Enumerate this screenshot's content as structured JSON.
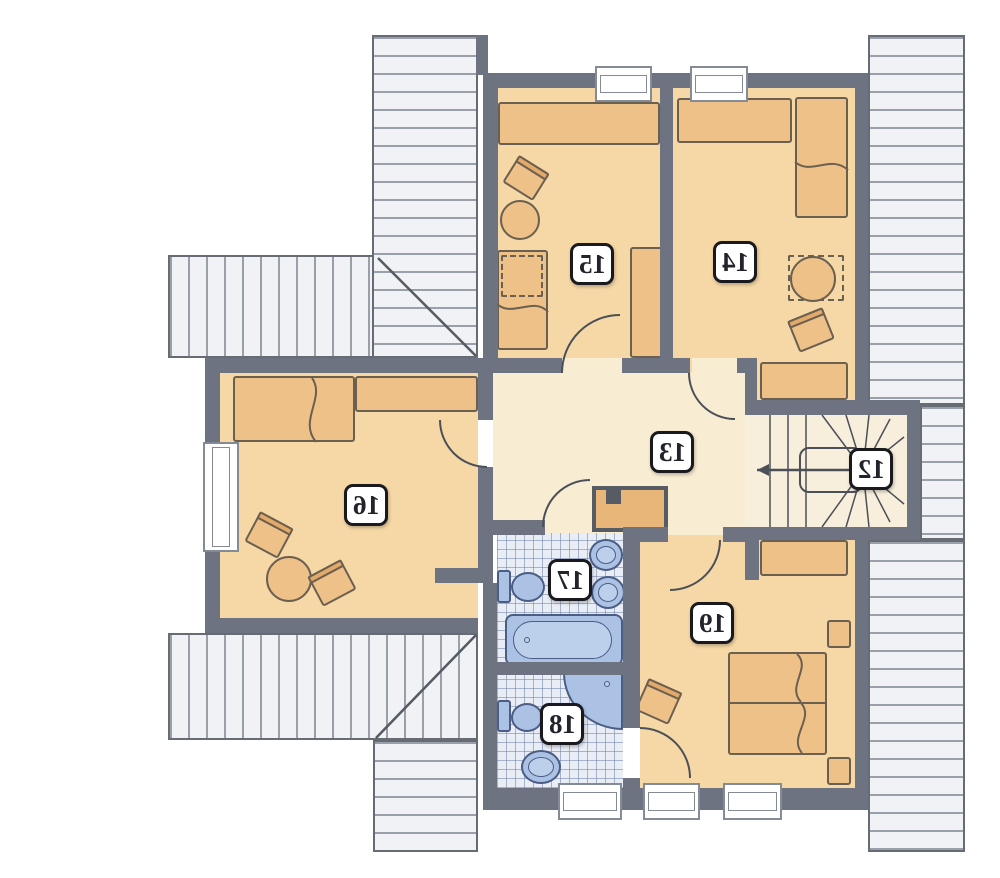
{
  "plan": {
    "type": "attic-floor-plan",
    "orientation": "mirrored",
    "room_count": 8
  },
  "rooms": [
    {
      "number": "12",
      "name": "staircase"
    },
    {
      "number": "13",
      "name": "hallway"
    },
    {
      "number": "14",
      "name": "bedroom"
    },
    {
      "number": "15",
      "name": "bedroom"
    },
    {
      "number": "16",
      "name": "bedroom"
    },
    {
      "number": "17",
      "name": "bathroom"
    },
    {
      "number": "18",
      "name": "bathroom"
    },
    {
      "number": "19",
      "name": "bedroom"
    }
  ],
  "fixtures": [
    "toilet",
    "washbasin",
    "bathtub",
    "corner-shower",
    "bed",
    "double-bed",
    "wardrobe",
    "table",
    "chair",
    "winder-staircase"
  ],
  "colors": {
    "wall": "#6d7380",
    "room_floor": "#f6d8a6",
    "hall_floor": "#f8ecd2",
    "stair_floor": "#f7efdc",
    "tile_floor": "#e9edf5",
    "furniture": "#eec189",
    "furniture_outline": "#6b5f50",
    "roof_fill": "#f0f2f5",
    "roof_line": "#9aa0aa",
    "fixture_fill": "#abc2e4",
    "fixture_outline": "#4b5d85",
    "label_bg": "#ffffff",
    "label_border": "#1a1a1e"
  }
}
